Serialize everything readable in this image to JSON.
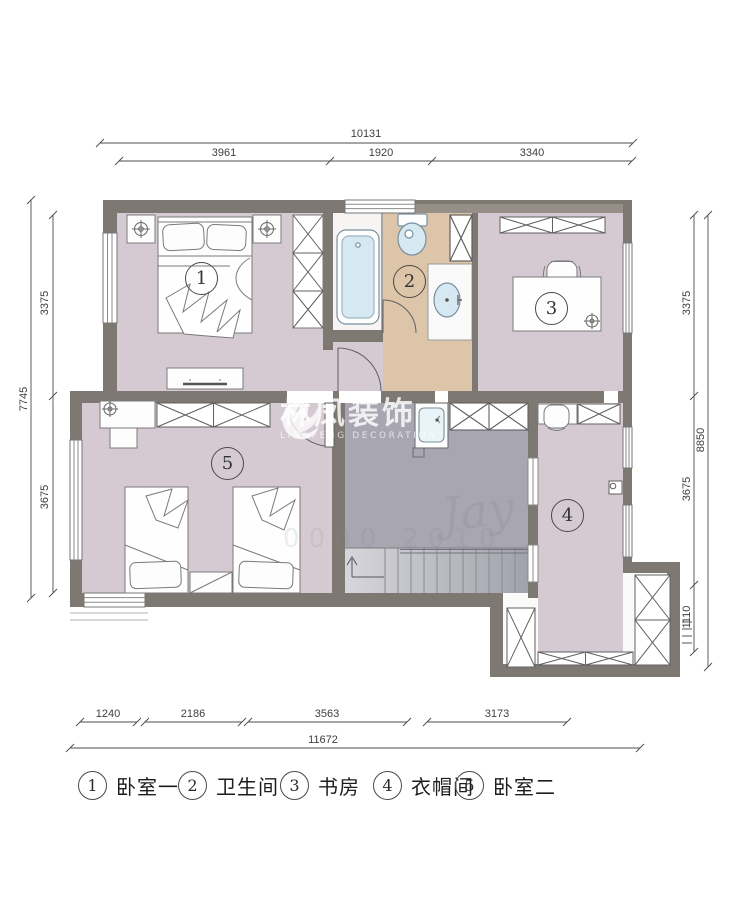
{
  "dimensions": {
    "top": {
      "total": "10131",
      "segments": [
        "3961",
        "1920",
        "3340"
      ]
    },
    "left": {
      "total": "7745",
      "segments": [
        "3375",
        "3675"
      ]
    },
    "right": {
      "total": "8850",
      "segments": [
        "3375",
        "3675",
        "1110"
      ]
    },
    "bottom": {
      "total": "11672",
      "segments": [
        "1240",
        "2186",
        "3563",
        "3173"
      ]
    }
  },
  "rooms": [
    {
      "number": "1",
      "label": "卧室一"
    },
    {
      "number": "2",
      "label": "卫生间"
    },
    {
      "number": "3",
      "label": "书房"
    },
    {
      "number": "4",
      "label": "衣帽间"
    },
    {
      "number": "5",
      "label": "卧室二"
    }
  ],
  "watermark": {
    "title": "林凤装饰",
    "subtitle": "LIN&FENG DECORATION"
  },
  "faint_watermarks": {
    "script": "Jay",
    "numbers": "0000 2010"
  },
  "colors": {
    "wall": "#7e7873",
    "floor_bedroom": "#d6cad2",
    "floor_bath": "#ddc5a9",
    "floor_hall": "#a7a6b1",
    "fixture_fill": "#d6e9f3",
    "dim_line": "#4d4d4d"
  }
}
